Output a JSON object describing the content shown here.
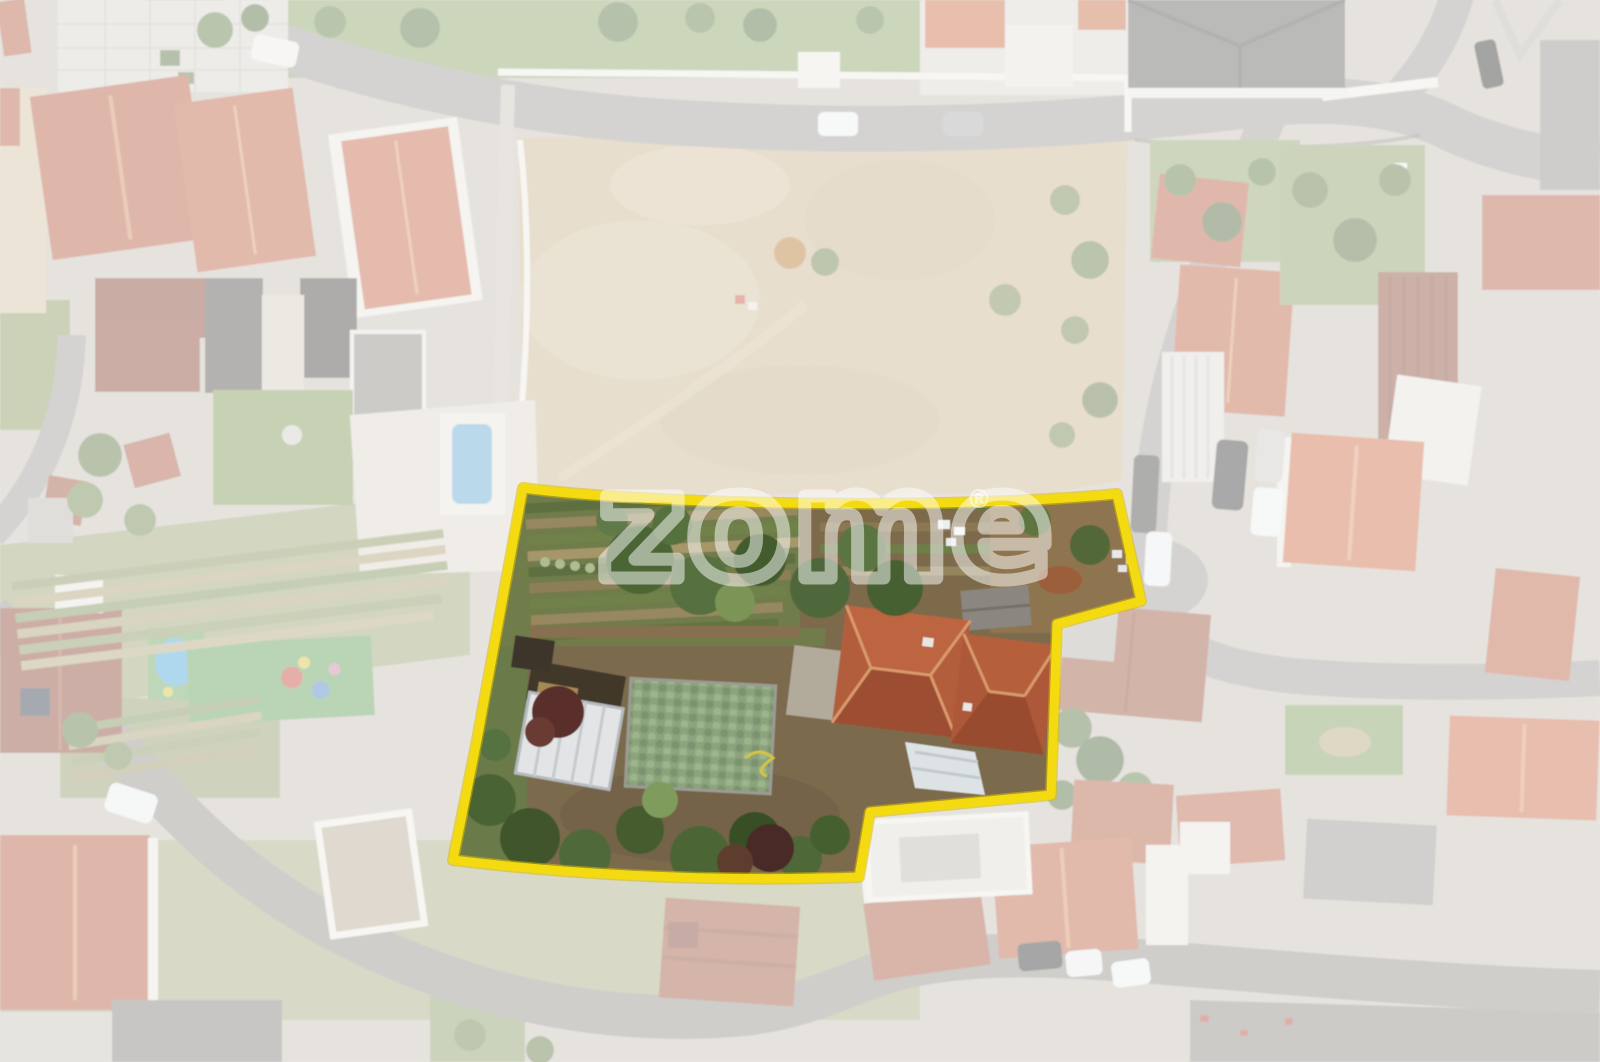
{
  "scene": {
    "kind": "aerial-drone-photo",
    "description": "Aerial photo of a residential neighborhood; a land parcel with vegetable gardens, trees, a greenhouse and a terracotta-roof house is outlined in yellow, and everything outside the outline is faded toward white.",
    "highlight": "yellow-outlined land parcel",
    "fade": "white wash over surroundings"
  },
  "watermark": {
    "text": "zome",
    "registered": "®",
    "color": "#ffffff",
    "opacity": 0.5
  },
  "boundary": {
    "color": "#f4da10",
    "halo_color": "#d9ba00",
    "stroke_width": 9
  },
  "overlay": {
    "color": "#ffffff",
    "opacity": 0.57
  },
  "palette": {
    "roof_terracotta": "#b25d3a",
    "roof_bright_orange": "#cc6a43",
    "roof_dark_maroon": "#823f2f",
    "roof_grey": "#615f5b",
    "road_grey": "#9d9a95",
    "field_tan": "#c9b28c",
    "grass_green": "#8aa163",
    "tree_green": "#4c6535",
    "dirt_brown": "#7c6a4e",
    "pool_blue": "#5fa8cf",
    "greenhouse_white": "#e2e4e6"
  }
}
